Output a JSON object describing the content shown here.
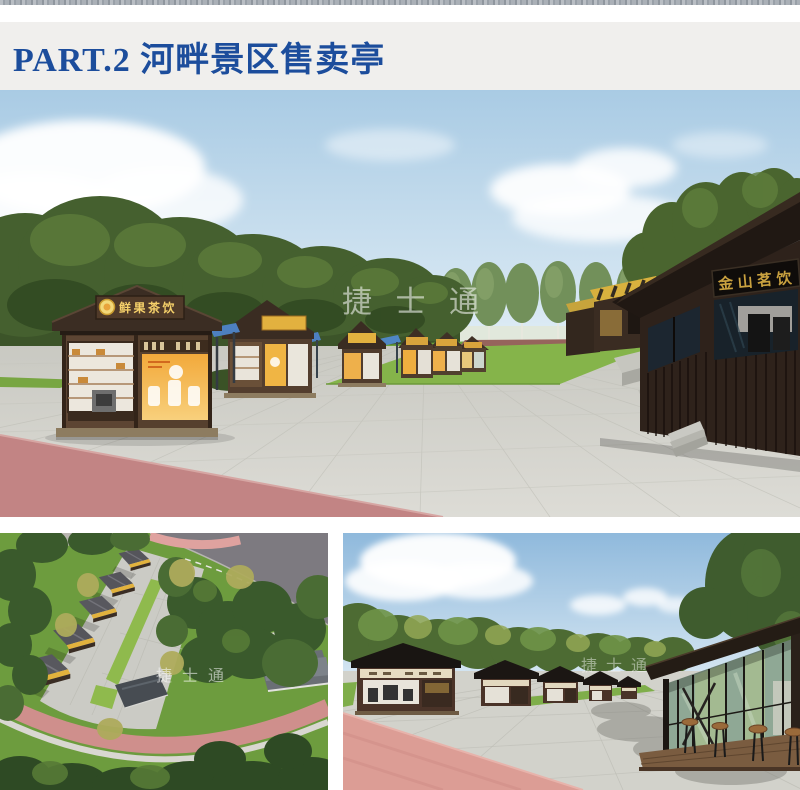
{
  "header": {
    "title": "PART.2 河畔景区售卖亭",
    "text_color": "#1c4d9c",
    "background": "#f0efed"
  },
  "main_render": {
    "watermark": "捷 士 通",
    "kiosk_sign_left": "鲜果茶饮",
    "kiosk_sign_right": "金山茗饮"
  },
  "aerial_render": {
    "watermark": "捷 士 通"
  },
  "plaza_render": {
    "watermark": "捷士通"
  },
  "colors": {
    "title_blue": "#1c4d9c",
    "header_gray": "#f0efed",
    "sky_blue": "#b6d2e8",
    "paving_gray": "#d5d5cf",
    "path_pink": "#c28484",
    "path_salmon": "#dc9d95",
    "grass_green": "#83b346",
    "tree_green": "#3f5a2e",
    "kiosk_brown": "#4c3727",
    "dark_kiosk": "#2e221b",
    "sign_gold": "#c9a13f",
    "menu_orange": "#f2ab3c",
    "awning_blue": "#4d80c0",
    "watermark_white": "#ffffff"
  }
}
